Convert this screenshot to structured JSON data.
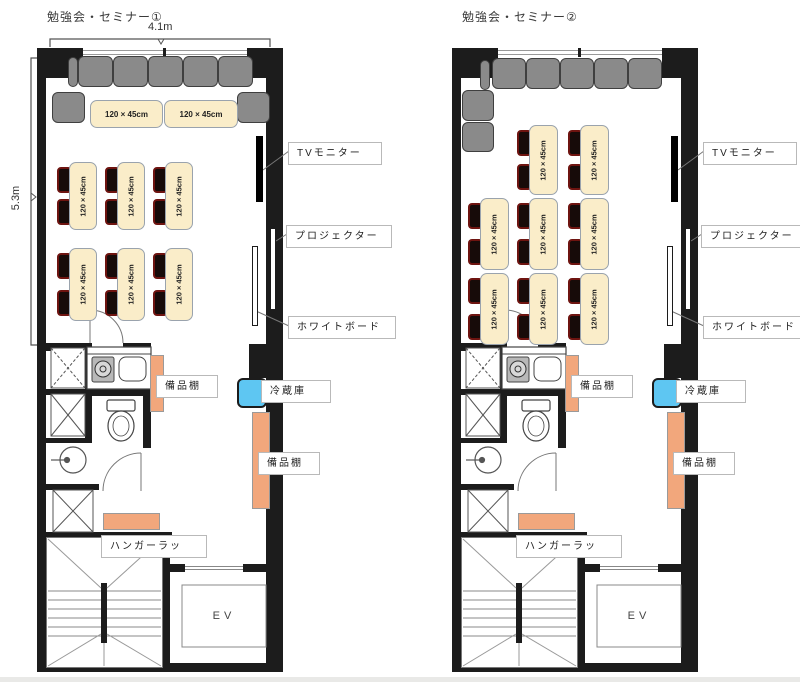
{
  "labels": {
    "table": "120 × 45cm",
    "tv": "TVモニター",
    "projector": "プロジェクター",
    "whiteboard": "ホワイトボード",
    "shelf": "備品棚",
    "fridge": "冷蔵庫",
    "hanger": "ハンガーラッ",
    "elevator": "EV"
  },
  "colors": {
    "wall": "#1c1c1c",
    "sofa": "#8a8a8a",
    "table_fill": "#faedc9",
    "chair": "#170b09",
    "chair_edge": "#6e1410",
    "shelf": "#f2a77c",
    "fridge": "#5ec6f2",
    "monitor": "#000000"
  },
  "plans": [
    {
      "title": "勉強会・セミナー①",
      "dimensions": {
        "width": "4.1m",
        "height": "5.3m"
      },
      "origin": {
        "x": 37,
        "y": 48
      },
      "sofas": [
        {
          "x": 31,
          "y": 9,
          "w": 10,
          "h": 30
        },
        {
          "x": 41,
          "y": 8,
          "w": 35,
          "h": 31
        },
        {
          "x": 76,
          "y": 8,
          "w": 35,
          "h": 31
        },
        {
          "x": 111,
          "y": 8,
          "w": 35,
          "h": 31
        },
        {
          "x": 146,
          "y": 8,
          "w": 35,
          "h": 31
        },
        {
          "x": 181,
          "y": 8,
          "w": 35,
          "h": 31
        },
        {
          "x": 15,
          "y": 44,
          "w": 33,
          "h": 31
        },
        {
          "x": 200,
          "y": 44,
          "w": 33,
          "h": 31
        }
      ],
      "tables_h": [
        {
          "x": 53,
          "y": 52,
          "w": 73,
          "h": 28
        },
        {
          "x": 127,
          "y": 52,
          "w": 74,
          "h": 28
        }
      ],
      "tables_v": [
        {
          "x": 32,
          "y": 114,
          "w": 28,
          "h": 68
        },
        {
          "x": 80,
          "y": 114,
          "w": 28,
          "h": 68
        },
        {
          "x": 128,
          "y": 114,
          "w": 28,
          "h": 68
        },
        {
          "x": 32,
          "y": 200,
          "w": 28,
          "h": 73
        },
        {
          "x": 80,
          "y": 200,
          "w": 28,
          "h": 73
        },
        {
          "x": 128,
          "y": 200,
          "w": 28,
          "h": 73
        }
      ]
    },
    {
      "title": "勉強会・セミナー②",
      "origin": {
        "x": 452,
        "y": 48
      },
      "sofas": [
        {
          "x": 28,
          "y": 12,
          "w": 10,
          "h": 30
        },
        {
          "x": 40,
          "y": 10,
          "w": 34,
          "h": 31
        },
        {
          "x": 74,
          "y": 10,
          "w": 34,
          "h": 31
        },
        {
          "x": 108,
          "y": 10,
          "w": 34,
          "h": 31
        },
        {
          "x": 142,
          "y": 10,
          "w": 34,
          "h": 31
        },
        {
          "x": 176,
          "y": 10,
          "w": 34,
          "h": 31
        },
        {
          "x": 10,
          "y": 42,
          "w": 32,
          "h": 31
        },
        {
          "x": 10,
          "y": 74,
          "w": 32,
          "h": 30
        }
      ],
      "tables_h": [],
      "tables_v": [
        {
          "x": 77,
          "y": 77,
          "w": 29,
          "h": 70
        },
        {
          "x": 128,
          "y": 77,
          "w": 29,
          "h": 70
        },
        {
          "x": 28,
          "y": 150,
          "w": 29,
          "h": 72
        },
        {
          "x": 77,
          "y": 150,
          "w": 29,
          "h": 72
        },
        {
          "x": 128,
          "y": 150,
          "w": 29,
          "h": 72
        },
        {
          "x": 28,
          "y": 225,
          "w": 29,
          "h": 72
        },
        {
          "x": 77,
          "y": 225,
          "w": 29,
          "h": 72
        },
        {
          "x": 128,
          "y": 225,
          "w": 29,
          "h": 72
        }
      ]
    }
  ],
  "equipment": {
    "tv": {
      "x": 219,
      "y": 88,
      "w": 7,
      "h": 66
    },
    "projector": {
      "x": 233,
      "y": 180,
      "w": 6,
      "h": 82
    },
    "whiteboard": {
      "x": 215,
      "y": 198,
      "w": 6,
      "h": 80
    },
    "shelf1": {
      "x": 113,
      "y": 307,
      "w": 14,
      "h": 57
    },
    "fridge": {
      "x": 200,
      "y": 330,
      "w": 30,
      "h": 30
    },
    "shelf2": {
      "x": 215,
      "y": 364,
      "w": 18,
      "h": 97
    },
    "hanger": {
      "x": 66,
      "y": 465,
      "w": 57,
      "h": 17
    },
    "ev_box": {
      "x": 145,
      "y": 537,
      "w": 84,
      "h": 62
    }
  },
  "annotations": [
    {
      "key": "tv",
      "name": "tv-monitor-label",
      "x": 251,
      "y": 94,
      "w": 80
    },
    {
      "key": "projector",
      "name": "projector-label",
      "x": 249,
      "y": 177,
      "w": 92
    },
    {
      "key": "whiteboard",
      "name": "whiteboard-label",
      "x": 251,
      "y": 268,
      "w": 94
    },
    {
      "key": "shelf",
      "name": "shelf-label-upper",
      "x": 119,
      "y": 327,
      "w": 48
    },
    {
      "key": "fridge",
      "name": "fridge-label",
      "x": 224,
      "y": 332,
      "w": 56
    },
    {
      "key": "shelf",
      "name": "shelf-label-lower",
      "x": 221,
      "y": 404,
      "w": 48
    },
    {
      "key": "hanger",
      "name": "hanger-rack-label",
      "x": 64,
      "y": 487,
      "w": 92
    }
  ]
}
